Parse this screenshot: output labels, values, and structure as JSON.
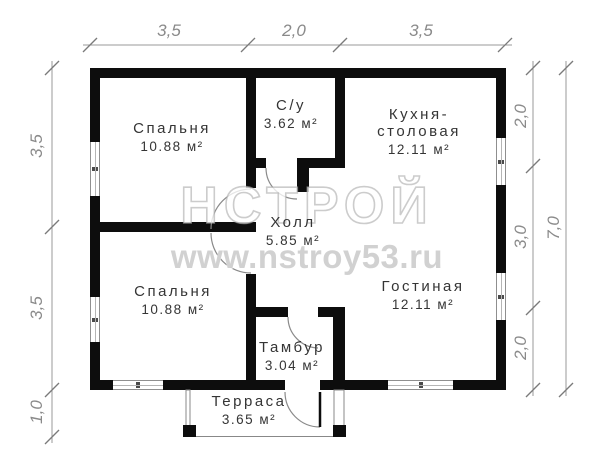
{
  "watermark": {
    "logo": "НСТРОЙ",
    "url": "www.nstroy53.ru"
  },
  "rooms": {
    "bedroom_top": {
      "name": "Спальня",
      "area": "10.88 м²"
    },
    "wc": {
      "name": "С/у",
      "area": "3.62 м²"
    },
    "kitchen": {
      "name_line1": "Кухня-",
      "name_line2": "столовая",
      "area": "12.11 м²"
    },
    "hall": {
      "name": "Холл",
      "area": "5.85 м²"
    },
    "bedroom_bottom": {
      "name": "Спальня",
      "area": "10.88 м²"
    },
    "living": {
      "name": "Гостиная",
      "area": "12.11 м²"
    },
    "tambour": {
      "name": "Тамбур",
      "area": "3.04 м²"
    },
    "terrace": {
      "name": "Терраса",
      "area": "3.65 м²"
    }
  },
  "dimensions": {
    "top": [
      "3,5",
      "2,0",
      "3,5"
    ],
    "left": [
      "3,5",
      "3,5",
      "1,0"
    ],
    "right_inner": [
      "2,0",
      "3,0",
      "2,0"
    ],
    "right_outer": "7,0"
  },
  "colors": {
    "wall": "#0d0d0d",
    "dimension": "#8a8a8a",
    "label": "#353535",
    "watermark": "#c5c5c5"
  }
}
